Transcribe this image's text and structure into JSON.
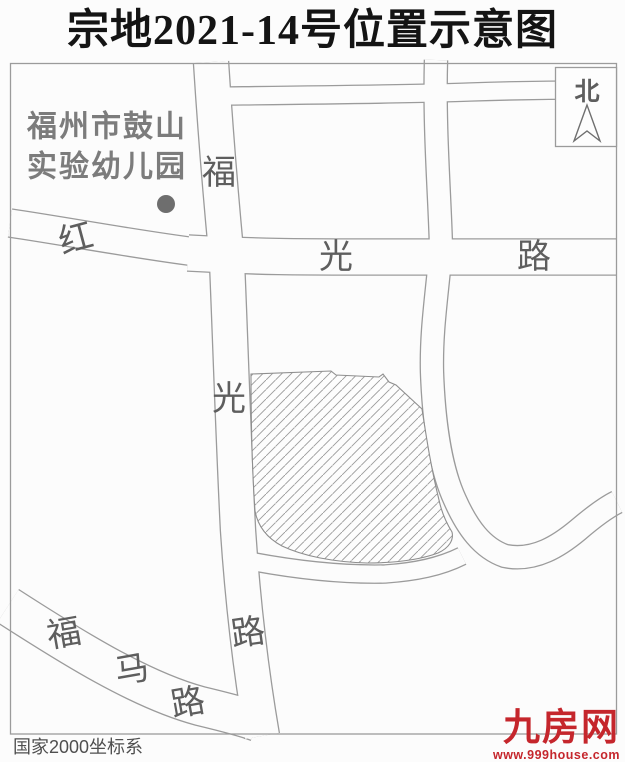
{
  "title": "宗地2021-14号位置示意图",
  "map": {
    "poi": {
      "line1": "福州市鼓山",
      "line2": "实验幼儿园"
    },
    "north": "北",
    "roads": {
      "hongguang": {
        "name": "红光路",
        "chars": [
          "红",
          "光",
          "路"
        ]
      },
      "fuguang": {
        "name": "福光路",
        "chars": [
          "福",
          "光",
          "路"
        ]
      },
      "fuma": {
        "name": "福马路",
        "chars": [
          "福",
          "马",
          "路"
        ]
      }
    },
    "coordinate_note": "国家2000坐标系"
  },
  "watermark": {
    "brand": "九房网",
    "url": "www.999house.com"
  },
  "colors": {
    "accent_red": "#c5262c",
    "line_gray": "#9b9b9b",
    "text_gray": "#5e5e5e",
    "parcel_hatch": "#9a9a9a"
  }
}
